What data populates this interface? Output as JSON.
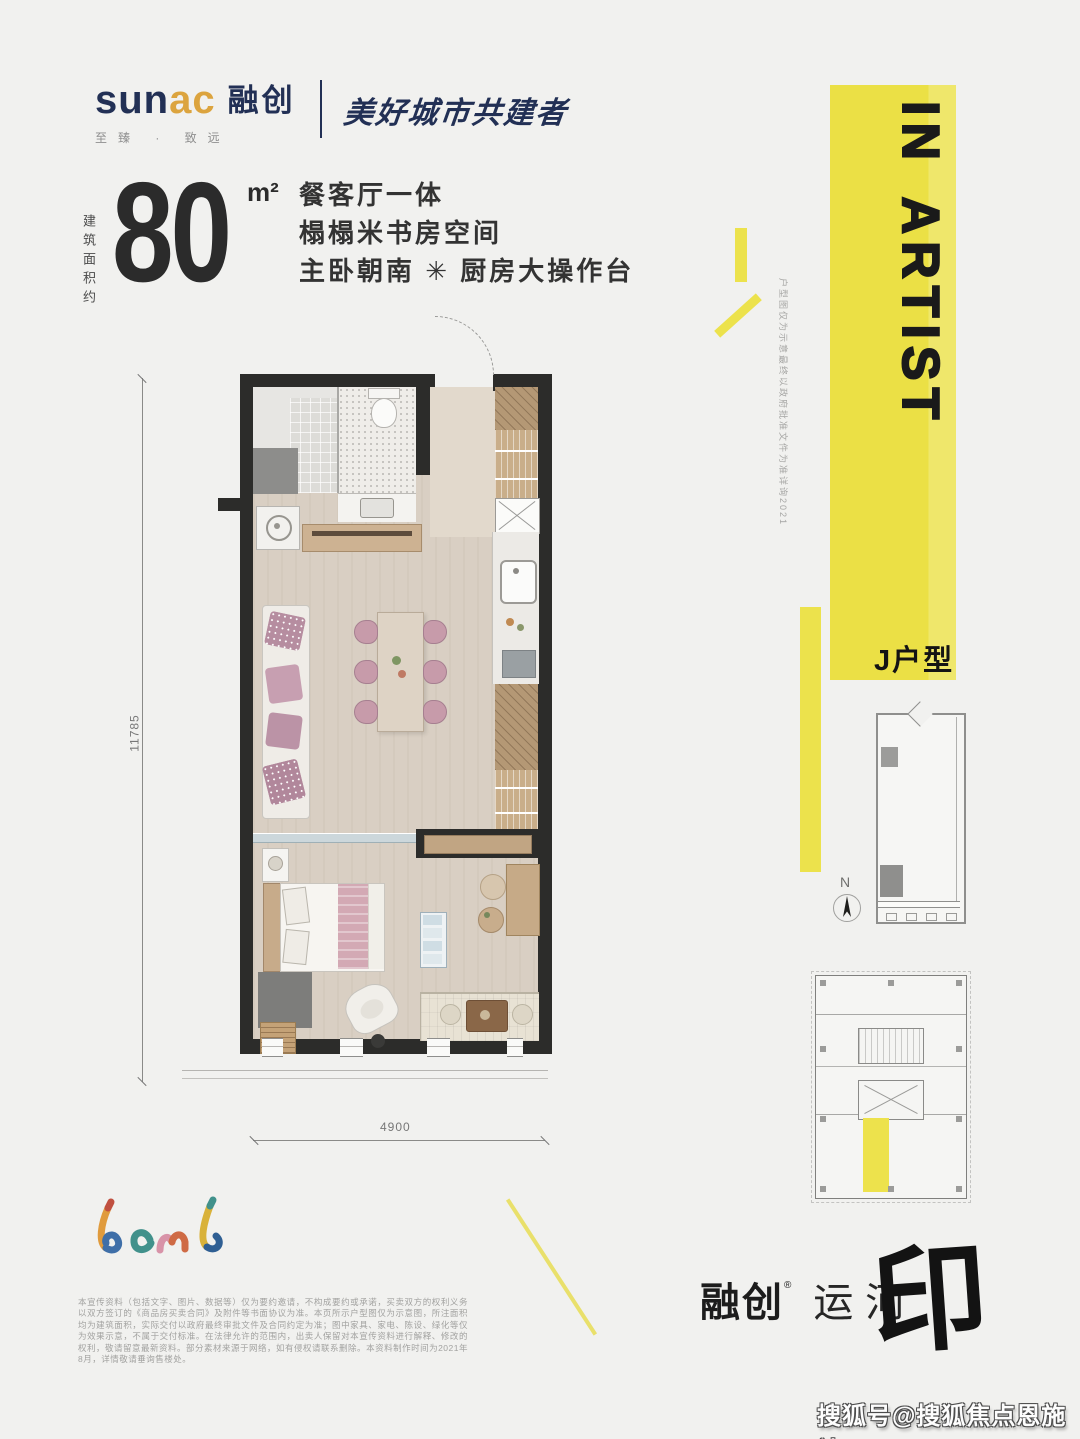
{
  "brand": {
    "latin_a": "sun",
    "latin_b": "ac",
    "cn": "融创",
    "values": "至臻 · 致远",
    "slogan": "美好城市共建者"
  },
  "spec": {
    "vertical_label": "建筑面积约",
    "area": "80",
    "unit": "m²",
    "features": [
      "餐客厅一体",
      "榻榻米书房空间",
      "主卧朝南 ✳ 厨房大操作台"
    ]
  },
  "plan": {
    "dim_height": "11785",
    "dim_width": "4900",
    "side_note": "户型图仅为示意最终以政府批准文件为准详询2021"
  },
  "banner": {
    "title": "IN ARTIST",
    "unit_label": "J户型"
  },
  "compass": {
    "north": "N"
  },
  "brandmark": {
    "script": "Leml"
  },
  "footer": {
    "disclaimer": "本宣传资料（包括文字、图片、数据等）仅为要约邀请，不构成要约或承诺，买卖双方的权利义务以双方签订的《商品房买卖合同》及附件等书面协议为准。本页所示户型图仅为示意图，所注面积均为建筑面积，实际交付以政府最终审批文件及合同约定为准；图中家具、家电、陈设、绿化等仅为效果示意，不属于交付标准。在法律允许的范围内，出卖人保留对本宣传资料进行解释、修改的权利，敬请留意最新资料。部分素材来源于网络，如有侵权请联系删除。本资料制作时间为2021年8月，详情敬请垂询售楼处。",
    "logo_cn": "融创",
    "logo_reg": "®",
    "logo_name": "运河",
    "logo_seal": "印"
  },
  "watermark": {
    "text": "搜狐号@搜狐焦点恩施站"
  }
}
